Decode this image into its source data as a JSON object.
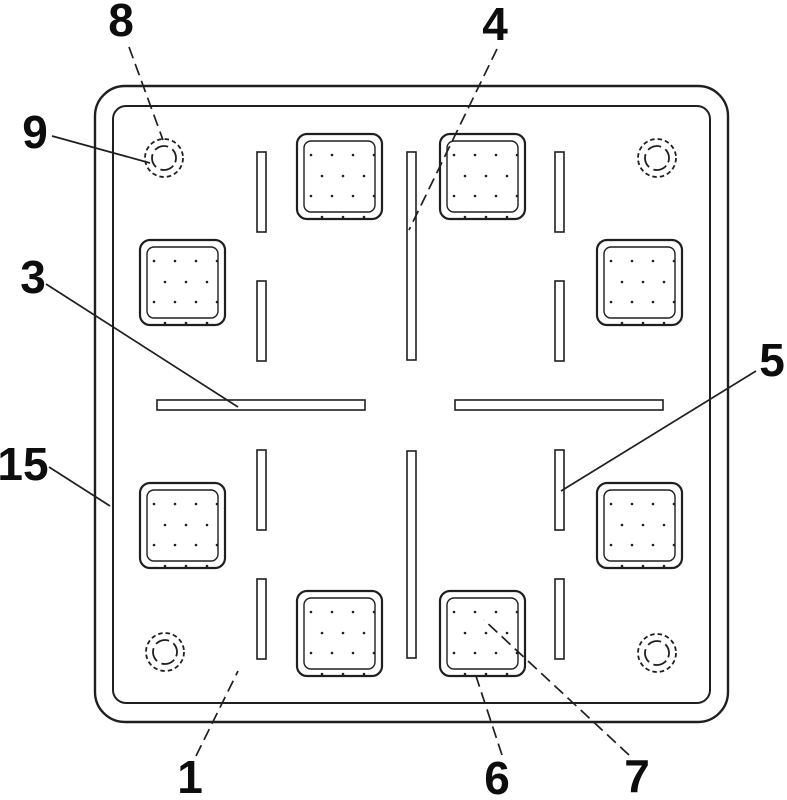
{
  "figure": {
    "kind": "patent-technical-drawing",
    "canvas": {
      "width": 787,
      "height": 800,
      "background": "#ffffff",
      "line_color": "#1f1f1f",
      "label_color": "#0d0d0d",
      "label_font_size": 46
    },
    "plate": {
      "outer": {
        "x": 95,
        "y": 86,
        "width": 633,
        "height": 636,
        "radius": 30,
        "stroke_width": 2.4
      },
      "inner": {
        "x": 113,
        "y": 106,
        "width": 597,
        "height": 597,
        "radius": 13,
        "stroke_width": 2
      }
    },
    "corner_holes": {
      "outer_radius": 19,
      "inner_radius": 12,
      "centers": [
        {
          "cx": 164,
          "cy": 158
        },
        {
          "cx": 657,
          "cy": 158
        },
        {
          "cx": 165,
          "cy": 652
        },
        {
          "cx": 657,
          "cy": 653
        }
      ]
    },
    "suction_pads": {
      "size": 85,
      "inner_inset": 7,
      "outer_radius": 10,
      "inner_radius": 7,
      "dot_rows": [
        {
          "dy": 14,
          "dx": [
            7,
            28,
            49,
            70
          ]
        },
        {
          "dy": 35,
          "dx": [
            18,
            39,
            60
          ]
        },
        {
          "dy": 55,
          "dx": [
            7,
            28,
            49,
            70
          ]
        },
        {
          "dy": 76,
          "dx": [
            18,
            39,
            60
          ]
        }
      ],
      "positions": [
        {
          "x": 297,
          "y": 134
        },
        {
          "x": 440,
          "y": 134
        },
        {
          "x": 140,
          "y": 240
        },
        {
          "x": 597,
          "y": 240
        },
        {
          "x": 140,
          "y": 483
        },
        {
          "x": 597,
          "y": 483
        },
        {
          "x": 297,
          "y": 591
        },
        {
          "x": 440,
          "y": 591
        }
      ]
    },
    "slots": [
      {
        "x": 407,
        "y": 152,
        "w": 9,
        "h": 208
      },
      {
        "x": 407,
        "y": 451,
        "w": 9,
        "h": 207
      },
      {
        "x": 157,
        "y": 400,
        "w": 208,
        "h": 10
      },
      {
        "x": 455,
        "y": 400,
        "w": 208,
        "h": 10
      },
      {
        "x": 257,
        "y": 152,
        "w": 9,
        "h": 80
      },
      {
        "x": 257,
        "y": 281,
        "w": 9,
        "h": 80
      },
      {
        "x": 257,
        "y": 450,
        "w": 9,
        "h": 80
      },
      {
        "x": 257,
        "y": 579,
        "w": 9,
        "h": 80
      },
      {
        "x": 555,
        "y": 152,
        "w": 9,
        "h": 80
      },
      {
        "x": 555,
        "y": 281,
        "w": 9,
        "h": 80
      },
      {
        "x": 555,
        "y": 450,
        "w": 9,
        "h": 80
      },
      {
        "x": 555,
        "y": 579,
        "w": 9,
        "h": 80
      }
    ],
    "reference_labels": [
      {
        "text": "8",
        "x": 121,
        "y": 20,
        "leader": {
          "x1": 129,
          "y1": 47,
          "x2": 163,
          "y2": 140,
          "dashed": true
        }
      },
      {
        "text": "9",
        "x": 35,
        "y": 132,
        "leader": {
          "x1": 52,
          "y1": 136,
          "x2": 150,
          "y2": 163,
          "dashed": false
        }
      },
      {
        "text": "3",
        "x": 33,
        "y": 277,
        "leader": {
          "x1": 46,
          "y1": 284,
          "x2": 238,
          "y2": 407,
          "dashed": false
        }
      },
      {
        "text": "15",
        "x": 23,
        "y": 464,
        "leader": {
          "x1": 49,
          "y1": 467,
          "x2": 110,
          "y2": 506,
          "dashed": false
        }
      },
      {
        "text": "4",
        "x": 495,
        "y": 24,
        "leader": {
          "x1": 497,
          "y1": 49,
          "x2": 409,
          "y2": 230,
          "dashed": true
        }
      },
      {
        "text": "5",
        "x": 772,
        "y": 360,
        "leader": {
          "x1": 756,
          "y1": 371,
          "x2": 561,
          "y2": 491,
          "dashed": false
        }
      },
      {
        "text": "1",
        "x": 190,
        "y": 777,
        "leader": {
          "x1": 196,
          "y1": 756,
          "x2": 238,
          "y2": 671,
          "dashed": true
        }
      },
      {
        "text": "6",
        "x": 497,
        "y": 778,
        "leader": {
          "x1": 502,
          "y1": 755,
          "x2": 475,
          "y2": 673,
          "dashed": true
        }
      },
      {
        "text": "7",
        "x": 637,
        "y": 776,
        "leader": {
          "x1": 629,
          "y1": 755,
          "x2": 484,
          "y2": 620,
          "dashed": true
        }
      }
    ]
  }
}
